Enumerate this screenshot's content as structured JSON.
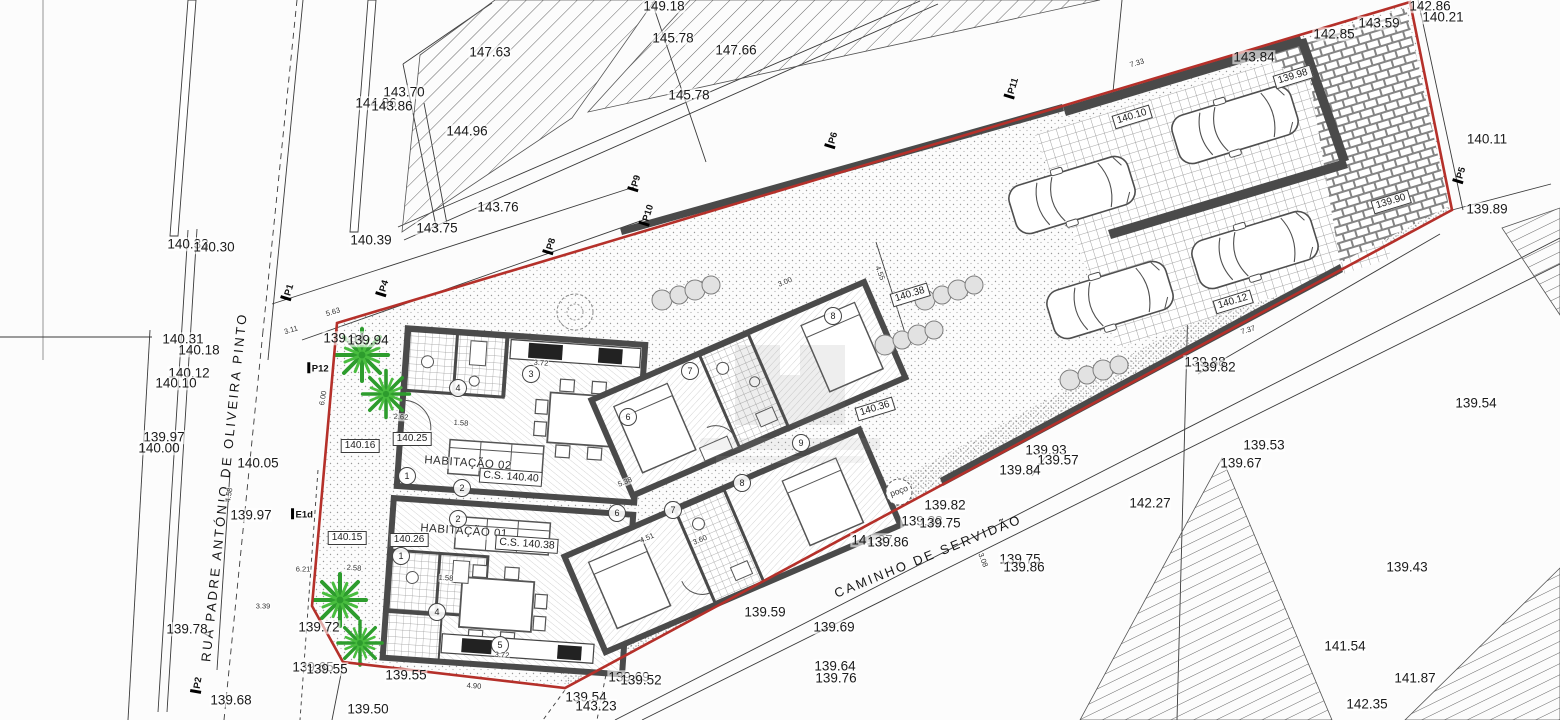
{
  "dwellings": [
    {
      "name": "HABITAÇÃO 02",
      "cs": "C.S. 140.40"
    },
    {
      "name": "HABITAÇÃO 01",
      "cs": "C.S. 140.38"
    }
  ],
  "well": {
    "label": "poço"
  },
  "colors": {
    "boundary": "#b5302a",
    "wall": "#4a4a4a",
    "tree_dark": "#2d9c2d",
    "tree_light": "#49bd3f"
  },
  "labels": {
    "street": [
      [
        "RUA PADRE ANTÓNIO DE OLIVEIRA PINTO",
        224,
        487,
        -84
      ],
      [
        "CAMINHO DE SERVIDÃO",
        928,
        556,
        -22
      ]
    ],
    "spot": [
      [
        "147.63",
        490,
        52
      ],
      [
        "143.70",
        404,
        92
      ],
      [
        "144.86",
        376,
        103
      ],
      [
        "143.86",
        392,
        106
      ],
      [
        "144.96",
        467,
        131
      ],
      [
        "143.76",
        498,
        207
      ],
      [
        "143.75",
        437,
        228
      ],
      [
        "140.33",
        188,
        244
      ],
      [
        "140.30",
        214,
        247
      ],
      [
        "140.39",
        371,
        240
      ],
      [
        "149.18",
        664,
        6
      ],
      [
        "145.78",
        673,
        38
      ],
      [
        "147.66",
        736,
        50
      ],
      [
        "145.78",
        689,
        95
      ],
      [
        "142.86",
        1430,
        6
      ],
      [
        "140.21",
        1443,
        17
      ],
      [
        "143.59",
        1379,
        23
      ],
      [
        "142.85",
        1334,
        34
      ],
      [
        "143.84",
        1254,
        57
      ],
      [
        "140.11",
        1487,
        139
      ],
      [
        "139.89",
        1487,
        209
      ],
      [
        "140.31",
        183,
        339
      ],
      [
        "140.18",
        199,
        350
      ],
      [
        "140.12",
        189,
        373
      ],
      [
        "140.10",
        176,
        383
      ],
      [
        "139.97",
        164,
        437
      ],
      [
        "140.00",
        159,
        448
      ],
      [
        "140.05",
        258,
        463
      ],
      [
        "139.97",
        251,
        515
      ],
      [
        "139.84",
        344,
        338
      ],
      [
        "139.94",
        368,
        340
      ],
      [
        "139.78",
        187,
        629
      ],
      [
        "139.72",
        319,
        627
      ],
      [
        "139.68",
        231,
        700
      ],
      [
        "139.65",
        313,
        667
      ],
      [
        "139.55",
        327,
        669
      ],
      [
        "139.55",
        406,
        675
      ],
      [
        "139.50",
        368,
        709
      ],
      [
        "139.54",
        586,
        697
      ],
      [
        "143.23",
        596,
        706
      ],
      [
        "139.69",
        629,
        677
      ],
      [
        "139.52",
        641,
        680
      ],
      [
        "139.59",
        765,
        612
      ],
      [
        "139.69",
        834,
        627
      ],
      [
        "139.64",
        835,
        666
      ],
      [
        "139.76",
        836,
        678
      ],
      [
        "139.93",
        1046,
        450
      ],
      [
        "139.57",
        1058,
        460
      ],
      [
        "139.84",
        1020,
        470
      ],
      [
        "139.82",
        945,
        505
      ],
      [
        "139.38",
        922,
        521
      ],
      [
        "139.75",
        940,
        523
      ],
      [
        "141.37",
        872,
        540
      ],
      [
        "139.86",
        888,
        542
      ],
      [
        "139.75",
        1020,
        559
      ],
      [
        "139.86",
        1024,
        567
      ],
      [
        "142.27",
        1150,
        503
      ],
      [
        "139.88",
        1205,
        362
      ],
      [
        "139.82",
        1215,
        367
      ],
      [
        "139.54",
        1476,
        403
      ],
      [
        "139.53",
        1264,
        445
      ],
      [
        "139.67",
        1241,
        463
      ],
      [
        "139.43",
        1407,
        567
      ],
      [
        "141.54",
        1345,
        646
      ],
      [
        "141.87",
        1415,
        678
      ],
      [
        "142.35",
        1367,
        704
      ]
    ],
    "boxed": [
      [
        "140.16",
        360,
        446
      ],
      [
        "140.25",
        412,
        439
      ],
      [
        "140.15",
        347,
        538
      ],
      [
        "140.26",
        409,
        540
      ],
      [
        "140.38",
        910,
        295,
        -17
      ],
      [
        "140.36",
        875,
        409,
        -17
      ],
      [
        "139.98",
        1293,
        77,
        -17
      ],
      [
        "139.90",
        1391,
        202,
        -17
      ],
      [
        "140.10",
        1132,
        117,
        -17
      ],
      [
        "140.12",
        1233,
        302,
        -17
      ]
    ],
    "marker": [
      [
        "P1",
        288,
        292,
        -73
      ],
      [
        "P4",
        383,
        288,
        -73
      ],
      [
        "P8",
        550,
        246,
        -73
      ],
      [
        "P9",
        635,
        183,
        -73
      ],
      [
        "P10",
        647,
        215,
        -73
      ],
      [
        "P6",
        832,
        140,
        -73
      ],
      [
        "P11",
        1012,
        88,
        -73
      ],
      [
        "P5",
        1460,
        175,
        -73
      ],
      [
        "P12",
        318,
        368,
        0
      ],
      [
        "E1d",
        302,
        514,
        0
      ],
      [
        "P2",
        197,
        685,
        -80
      ]
    ],
    "room": [
      [
        "3",
        531,
        374
      ],
      [
        "4",
        458,
        388
      ],
      [
        "1",
        407,
        476
      ],
      [
        "2",
        462,
        488
      ],
      [
        "1",
        401,
        556
      ],
      [
        "2",
        458,
        519
      ],
      [
        "4",
        437,
        612
      ],
      [
        "5",
        500,
        645
      ],
      [
        "6",
        628,
        417
      ],
      [
        "7",
        690,
        371
      ],
      [
        "8",
        833,
        316
      ],
      [
        "6",
        617,
        513
      ],
      [
        "7",
        673,
        510
      ],
      [
        "8",
        742,
        483
      ],
      [
        "9",
        801,
        443
      ]
    ],
    "dim": [
      [
        "3.72",
        541,
        363,
        4
      ],
      [
        "1.58",
        461,
        423,
        4
      ],
      [
        "2.62",
        401,
        417,
        4
      ],
      [
        "3.72",
        502,
        655,
        4
      ],
      [
        "4.90",
        474,
        686,
        4
      ],
      [
        "1.58",
        446,
        578,
        4
      ],
      [
        "2.58",
        354,
        568,
        4
      ],
      [
        "3.00",
        785,
        282,
        -23
      ],
      [
        "4.51",
        647,
        538,
        -23
      ],
      [
        "5.38",
        625,
        482,
        -23
      ],
      [
        "3.60",
        700,
        540,
        -23
      ],
      [
        "7.37",
        1248,
        330,
        -17
      ],
      [
        "7.33",
        1137,
        63,
        -17
      ],
      [
        "5.63",
        333,
        312,
        -17
      ],
      [
        "3.11",
        291,
        330,
        -17
      ],
      [
        "6.21",
        303,
        569,
        0
      ],
      [
        "3.39",
        263,
        606,
        0
      ],
      [
        "4.58",
        229,
        495,
        -80
      ],
      [
        "6.00",
        323,
        398,
        -80
      ],
      [
        "4.55",
        880,
        273,
        69
      ],
      [
        "3.08",
        983,
        560,
        69
      ]
    ]
  }
}
